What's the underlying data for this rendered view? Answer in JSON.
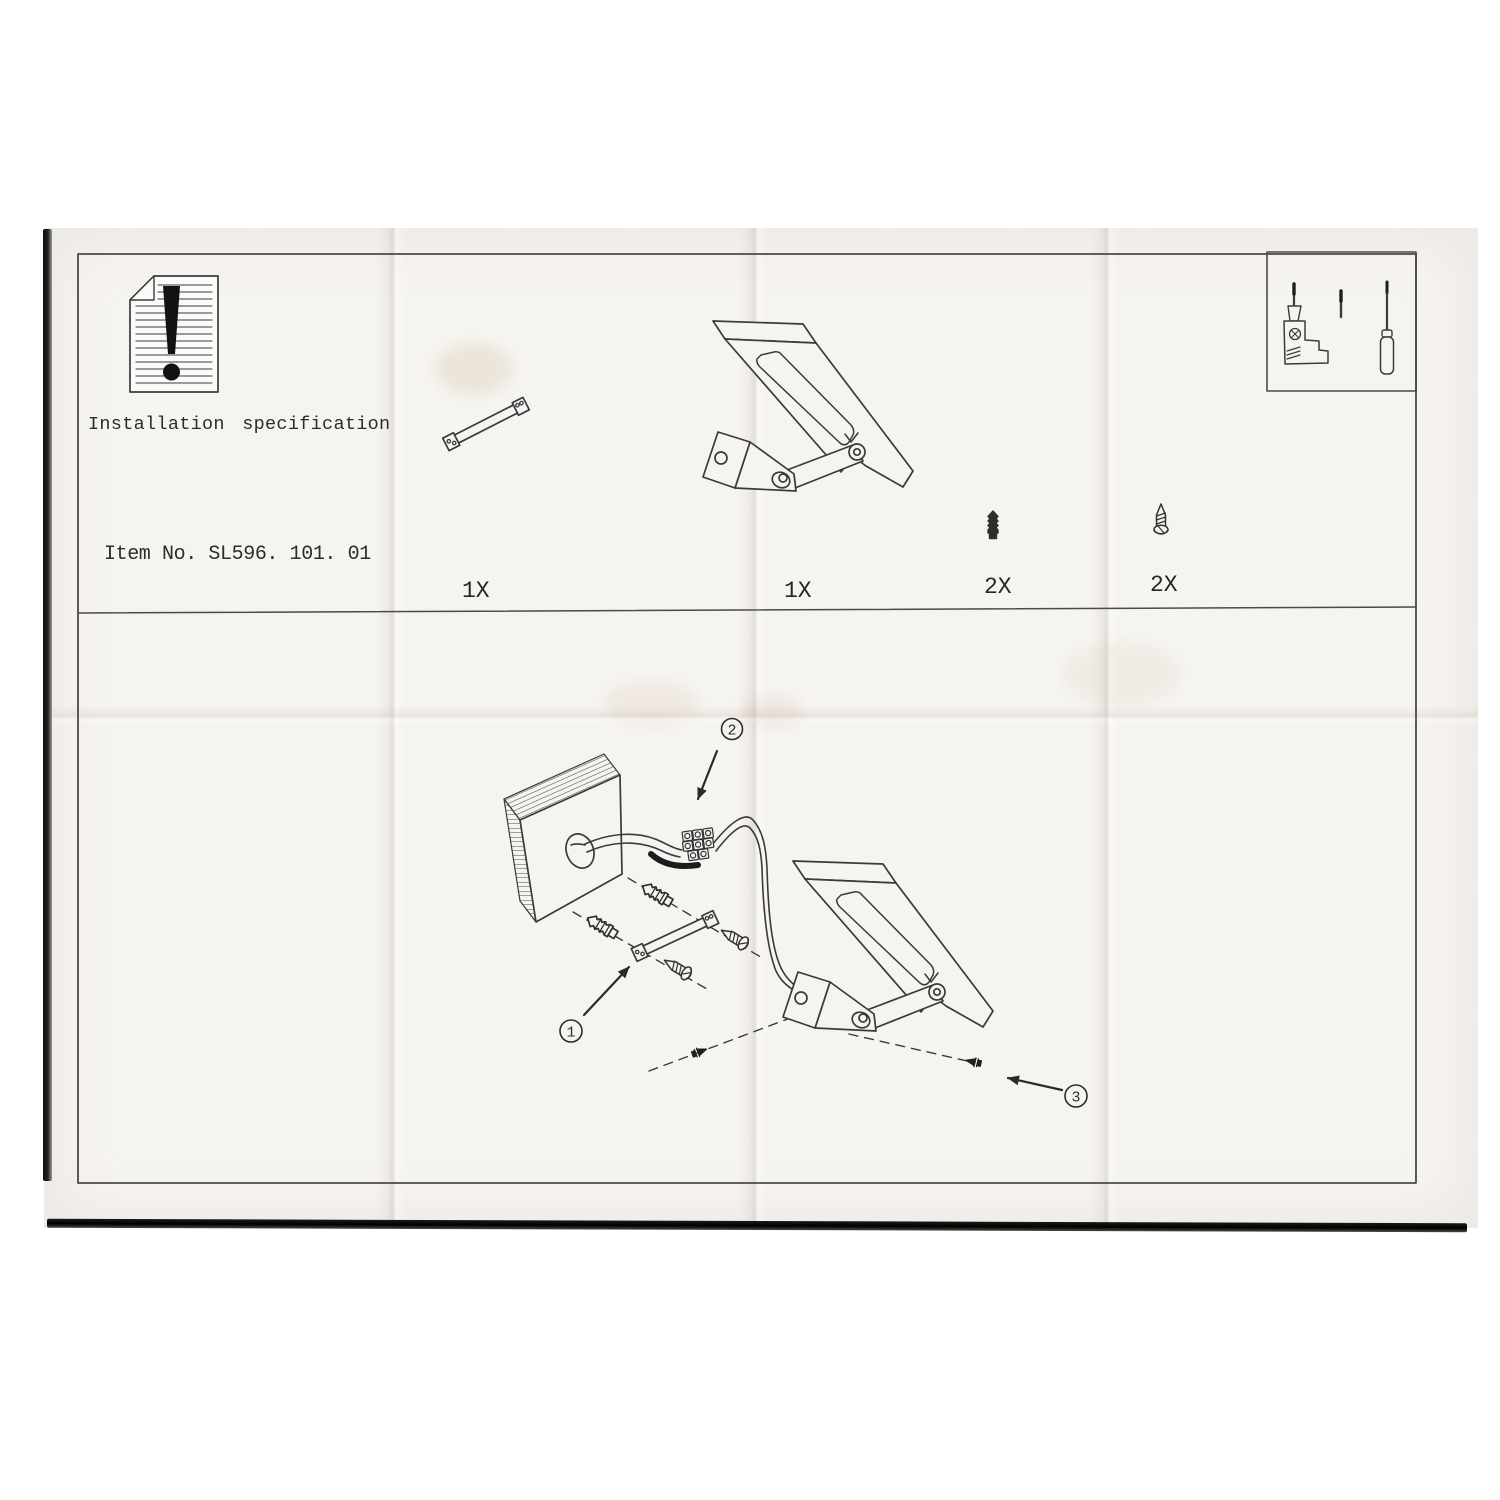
{
  "sheet": {
    "heading": "Installation specification",
    "item_no": "Item No. SL596. 101. 01"
  },
  "parts_row": [
    {
      "part": "mounting-bar",
      "qty": "1X"
    },
    {
      "part": "wall-lamp-assembly",
      "qty": "1X"
    },
    {
      "part": "wall-anchor",
      "qty": "2X"
    },
    {
      "part": "mounting-screw",
      "qty": "2X"
    }
  ],
  "tools": [
    "electric-drill",
    "drill-bit",
    "screwdriver"
  ],
  "steps": [
    {
      "number": "1"
    },
    {
      "number": "2"
    },
    {
      "number": "3"
    }
  ],
  "colors": {
    "paper": "#f6f4f1",
    "ink": "#3a3a3a",
    "scan_background": "#ffffff",
    "edge_shadow": "#161616"
  }
}
